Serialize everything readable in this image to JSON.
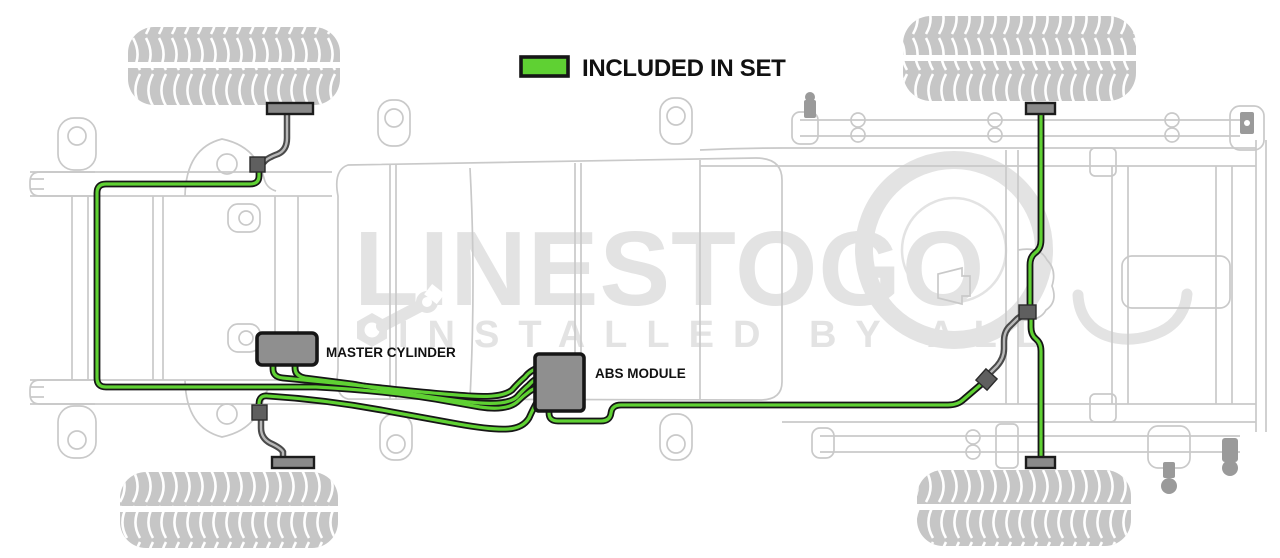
{
  "legend": {
    "label": "INCLUDED IN SET"
  },
  "labels": {
    "master_cylinder": "MASTER CYLINDER",
    "abs_module": "ABS MODULE"
  },
  "watermark": {
    "line1": "LINESTOGO",
    "line2": "INSTALLED BY ALL",
    "icon": "wrench-icon"
  },
  "colors": {
    "line_green": "#5fd133",
    "line_outline": "#161616",
    "chassis_gray": "#c9c9c9",
    "component_gray": "#8f8f8f",
    "tire_gray": "#c6c6c6",
    "hose_dark": "#4a4a4a",
    "watermark_gray": "#e3e3e3",
    "label_black": "#111111"
  }
}
